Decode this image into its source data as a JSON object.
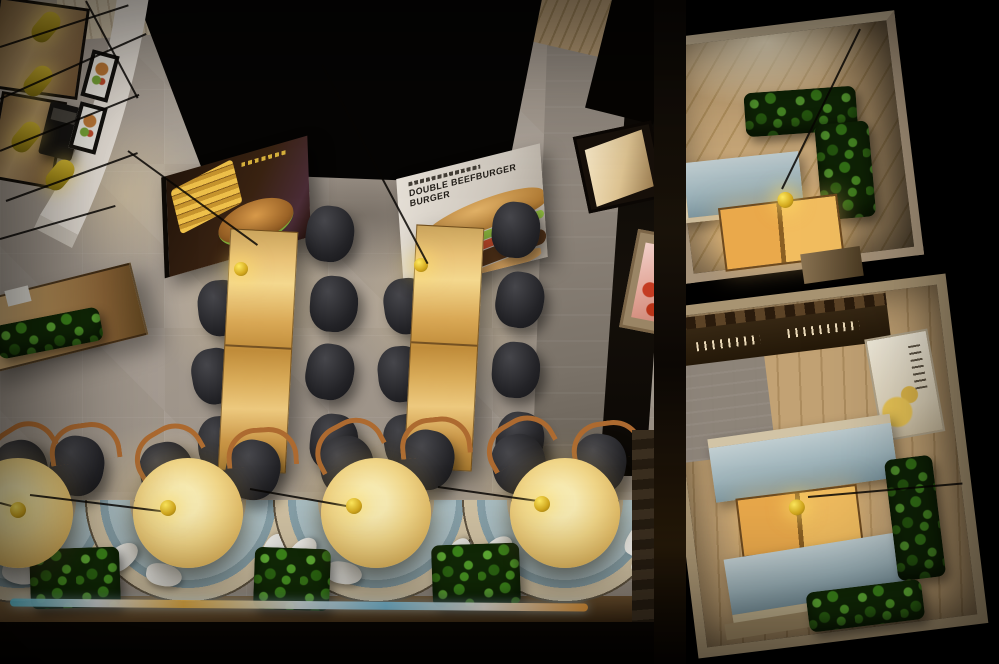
{
  "menu_wall_board": {
    "headline_line1": "DOUBLE BEEFBURGER",
    "headline_line2": "BURGER"
  },
  "palette": {
    "floor_grey": "#a79d92",
    "ceiling_black": "#060504",
    "counter_white": "#efe8df",
    "table_wood": "#d9a855",
    "round_table_lit": "#f0d587",
    "chair_charcoal": "#232327",
    "chair_arm_wood": "#ad6a30",
    "booth_cushion_blue": "#a9bec5",
    "booth_rim_cream": "#cfc0a2",
    "plant_green": "#3f8c1c",
    "lamp_yellow": "#d3a81d",
    "menu_board_dark": "#3a2312",
    "menu_board_light": "#cdc6bc",
    "room_wood_floor": "#c9a879",
    "poster_pink": "#e3a89a"
  },
  "scene": {
    "description": "Top-down 3D rendering of a fast-food burger restaurant interior",
    "service_counter": {
      "label": "curved service counter",
      "pendant_lamps": 4,
      "menu_lightboxes": 2,
      "cash_register": 1
    },
    "main_dining": {
      "label": "main dining area",
      "table_groups": 2,
      "chairs_per_group": 7,
      "hanging_menu_boards": 2
    },
    "booth_row": {
      "label": "semicircle booth seating",
      "booths": 4,
      "round_tables": 4,
      "pendant_lamps": 4,
      "planter_boxes": 3,
      "wood_arm_chairs": 8
    },
    "private_room_top": {
      "label": "private dining room top right",
      "elements": [
        "L-shaped hedge",
        "blue bench",
        "wood table",
        "pendant lamp"
      ]
    },
    "private_room_bottom": {
      "label": "private dining room bottom right",
      "elements": [
        "two blue benches",
        "wood table",
        "pendant lamp",
        "hedges",
        "wall poster",
        "coat rack"
      ]
    }
  }
}
